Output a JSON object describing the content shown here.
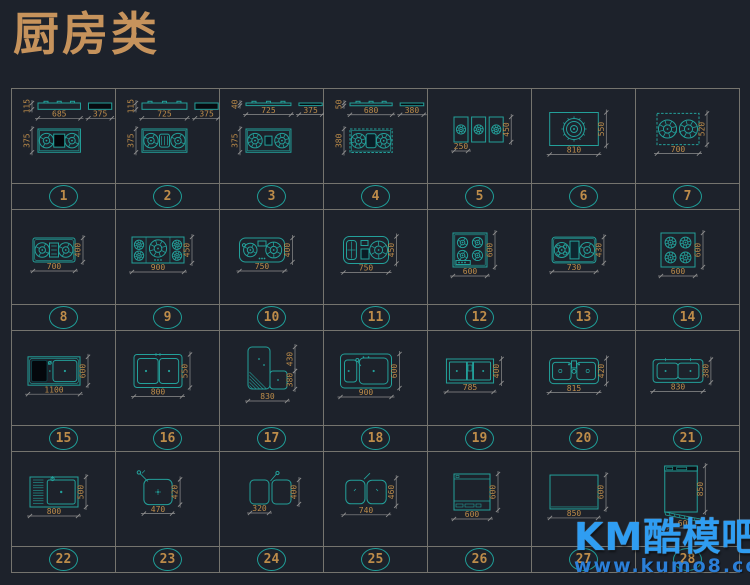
{
  "title": "厨房类",
  "watermark": {
    "brand": "KM酷模吧",
    "url": "www.kumo8.com"
  },
  "colors": {
    "background": "#1d222b",
    "teal": "#23a09a",
    "orange": "#bd8c4a",
    "dim_line": "#8f8f8f",
    "grid_line": "#75746e",
    "title": "#c6935c",
    "watermark_blue": "#2f9df2",
    "dark_fill": "#04070c"
  },
  "items": [
    {
      "num": "1",
      "type": "hob3",
      "variant": "solid",
      "front_h": "115",
      "width": "685",
      "side": "375",
      "depth": "375"
    },
    {
      "num": "2",
      "type": "hob3",
      "variant": "grill",
      "front_h": "115",
      "width": "725",
      "side": "375",
      "depth": "375"
    },
    {
      "num": "3",
      "type": "hob3",
      "variant": "hatch",
      "front_h": "40",
      "width": "725",
      "side": "375",
      "depth": "375"
    },
    {
      "num": "4",
      "type": "hob3",
      "variant": "hatch2",
      "front_h": "50",
      "width": "680",
      "side": "380",
      "depth": "380"
    },
    {
      "num": "5",
      "type": "modules",
      "width": "250",
      "height": "450"
    },
    {
      "num": "6",
      "type": "single",
      "width": "810",
      "height": "550"
    },
    {
      "num": "7",
      "type": "plan",
      "style": "b2dash",
      "width": "700",
      "height": "520"
    },
    {
      "num": "8",
      "type": "plan",
      "style": "b2panel",
      "width": "700",
      "height": "400"
    },
    {
      "num": "9",
      "type": "plan",
      "style": "b5",
      "width": "900",
      "height": "450"
    },
    {
      "num": "10",
      "type": "plan",
      "style": "b2round",
      "width": "750",
      "height": "400"
    },
    {
      "num": "11",
      "type": "plan",
      "style": "b2round2",
      "width": "750",
      "height": "450"
    },
    {
      "num": "12",
      "type": "plan",
      "style": "b4inner",
      "width": "600",
      "height": "600"
    },
    {
      "num": "13",
      "type": "plan",
      "style": "b2wok",
      "width": "730",
      "height": "430"
    },
    {
      "num": "14",
      "type": "plan",
      "style": "b4",
      "width": "600",
      "height": "600"
    },
    {
      "num": "15",
      "type": "sink",
      "style": "dark-double",
      "width": "1100",
      "height": "600"
    },
    {
      "num": "16",
      "type": "sink",
      "style": "double",
      "width": "800",
      "height": "550"
    },
    {
      "num": "17",
      "type": "corner",
      "width": "830",
      "height_top": "430",
      "height_bottom": "380"
    },
    {
      "num": "18",
      "type": "sink",
      "style": "offset",
      "width": "900",
      "height": "600"
    },
    {
      "num": "19",
      "type": "sink",
      "style": "divided",
      "width": "785",
      "height": "400"
    },
    {
      "num": "20",
      "type": "sink",
      "style": "faucet-center",
      "width": "815",
      "height": "420"
    },
    {
      "num": "21",
      "type": "sink",
      "style": "double-slim",
      "width": "830",
      "height": "380"
    },
    {
      "num": "22",
      "type": "sink",
      "style": "drainboard",
      "width": "800",
      "height": "500"
    },
    {
      "num": "23",
      "type": "sink",
      "style": "single",
      "width": "470",
      "height": "420"
    },
    {
      "num": "24",
      "type": "sink",
      "style": "twin-sep",
      "width": "320",
      "height": "400"
    },
    {
      "num": "25",
      "type": "sink",
      "style": "double-round",
      "width": "740",
      "height": "460"
    },
    {
      "num": "26",
      "type": "front",
      "style": "detail",
      "width": "600",
      "height": "600"
    },
    {
      "num": "27",
      "type": "front",
      "style": "plain",
      "width": "850",
      "height": "600"
    },
    {
      "num": "28",
      "type": "front",
      "style": "open-door",
      "width": "600",
      "height": "850"
    }
  ]
}
